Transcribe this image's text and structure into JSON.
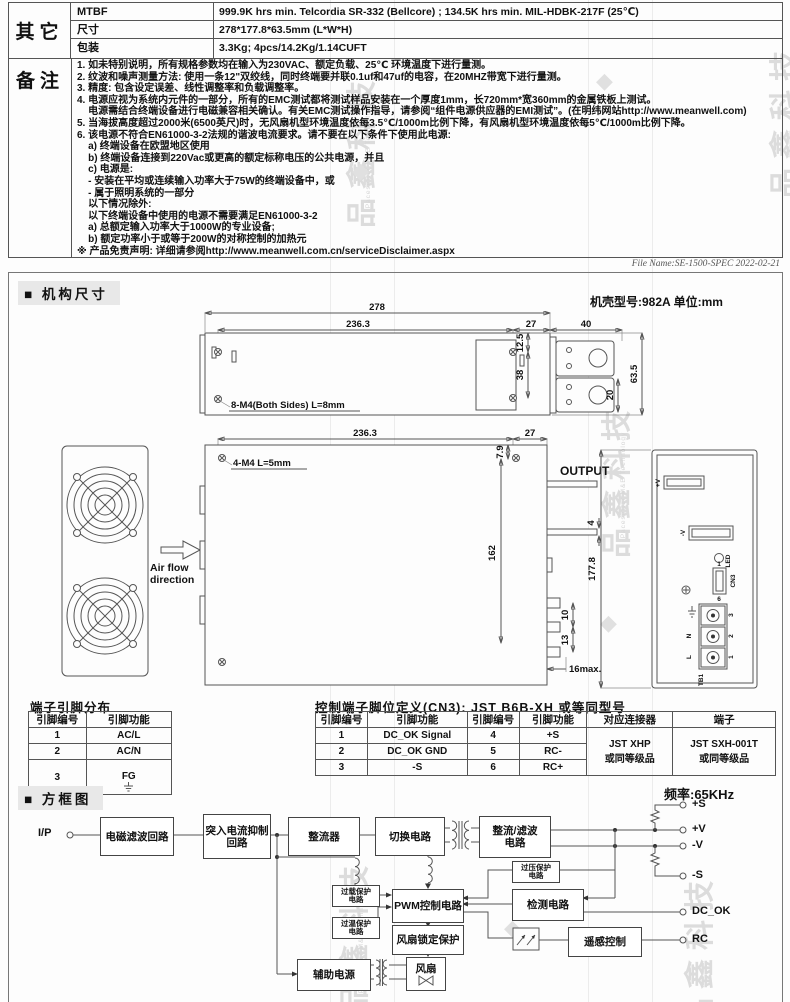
{
  "colors": {
    "section_bg": "#e8e8e8",
    "border": "#555555",
    "watermark": "#dcdcdc"
  },
  "spec": {
    "group": "其它",
    "rows": [
      {
        "name": "MTBF",
        "value": "999.9K hrs min. Telcordia SR-332 (Bellcore) ; 134.5K hrs min. MIL-HDBK-217F (25℃)"
      },
      {
        "name": "尺寸",
        "value": "278*177.8*63.5mm (L*W*H)"
      },
      {
        "name": "包装",
        "value": "3.3Kg; 4pcs/14.2Kg/1.14CUFT"
      }
    ]
  },
  "notes": {
    "group": "备注",
    "lines": [
      "1. 如未特别说明，所有规格参数均在输入为230VAC、额定负载、25℃ 环境温度下进行量测。",
      "2. 纹波和噪声测量方法: 使用一条12\"双绞线，同时终端要并联0.1uf和47uf的电容，在20MHZ带宽下进行量测。",
      "3. 精度: 包含设定误差、线性调整率和负载调整率。",
      "4. 电源应视为系统内元件的一部分，所有的EMC测试都将测试样品安装在一个厚度1mm，长720mm*宽360mm的金属铁板上测试。",
      "    电源需结合终端设备进行电磁兼容相关确认。有关EMC测试操作指导，请参阅“组件电源供应器的EMI测试”。(在明纬网站http://www.meanwell.com)",
      "5. 当海拔高度超过2000米(6500英尺)时，无风扇机型环境温度依每3.5℃/1000m比例下降，有风扇机型环境温度依每5℃/1000m比例下降。",
      "6. 该电源不符合EN61000-3-2法规的谐波电流要求。请不要在以下条件下使用此电源:",
      "    a) 终端设备在欧盟地区使用",
      "    b) 终端设备连接到220Vac或更高的额定标称电压的公共电源，并且",
      "    c) 电源是:",
      "    - 安装在平均或连续输入功率大于75W的终端设备中，或",
      "    - 属于照明系统的一部分",
      "    以下情况除外:",
      "    以下终端设备中使用的电源不需要满足EN61000-3-2",
      "    a) 总额定输入功率大于1000W的专业设备;",
      "    b) 额定功率小于或等于200W的对称控制的加热元",
      "※ 产品免责声明: 详细请参阅http://www.meanwell.com.cn/serviceDisclaimer.aspx"
    ]
  },
  "file_name": "File Name:SE-1500-SPEC  2022-02-21",
  "mech": {
    "bullet": "■",
    "title": "机构尺寸",
    "case_info": "机壳型号:982A  单位:mm",
    "side": {
      "d278": "278",
      "d236": "236.3",
      "d27": "27",
      "d40": "40",
      "d125": "12.5",
      "d38": "38",
      "d20": "20",
      "d635": "63.5",
      "screw": "8-M4(Both Sides) L=8mm"
    },
    "top": {
      "d236": "236.3",
      "d27": "27",
      "d79": "7.9",
      "d4": "4",
      "d162": "162",
      "d10": "10",
      "d13": "13",
      "d16": "16max.",
      "screw": "4-M4 L=5mm",
      "output": "OUTPUT"
    },
    "rear": {
      "d1778": "177.8",
      "vp": "+V",
      "vm": "-V",
      "led": "LED",
      "cn3": "CN3",
      "tb1": "TB1",
      "l": "L",
      "n": "N",
      "t1": "1",
      "t2": "2",
      "t3": "3",
      "p1": "1",
      "p6": "6"
    },
    "airflow": "Air flow\ndirection"
  },
  "pin_table": {
    "title": "端子引脚分布",
    "headers": [
      "引脚编号",
      "引脚功能"
    ],
    "rows": [
      [
        "1",
        "AC/L"
      ],
      [
        "2",
        "AC/N"
      ],
      [
        "3",
        "FG"
      ]
    ]
  },
  "cn3_table": {
    "title": "控制端子脚位定义(CN3): JST B6B-XH 或等同型号",
    "headers": [
      "引脚编号",
      "引脚功能",
      "引脚编号",
      "引脚功能",
      "对应连接器",
      "端子"
    ],
    "rows": [
      [
        "1",
        "DC_OK Signal",
        "4",
        "+S"
      ],
      [
        "2",
        "DC_OK GND",
        "5",
        "RC-"
      ],
      [
        "3",
        "-S",
        "6",
        "RC+"
      ]
    ],
    "connector": "JST XHP\n或同等级品",
    "terminal": "JST SXH-001T\n或同等级品"
  },
  "block": {
    "bullet": "■",
    "title": "方框图",
    "freq": "频率:65KHz",
    "input": "I/P",
    "emi": "电磁滤波回路",
    "inrush": "突入电流抑制\n回路",
    "rectifier": "整流器",
    "switching": "切换电路",
    "rectfilter": "整流/滤波\n电路",
    "ovp": "过压保护\n电路",
    "olp": "过载保护\n电路",
    "otp": "过温保护\n电路",
    "pwm": "PWM控制电路",
    "fanlock": "风扇锁定保护",
    "detection": "检测电路",
    "remote": "遥感控制",
    "aux": "辅助电源",
    "fan": "风扇",
    "sp": "+S",
    "vp": "+V",
    "vm": "-V",
    "sm": "-S",
    "dcok": "DC_OK",
    "rc": "RC"
  },
  "watermark": {
    "cn": "品鑫科技",
    "en": "Pacesetter M&E Technology",
    "logo": "◆"
  }
}
